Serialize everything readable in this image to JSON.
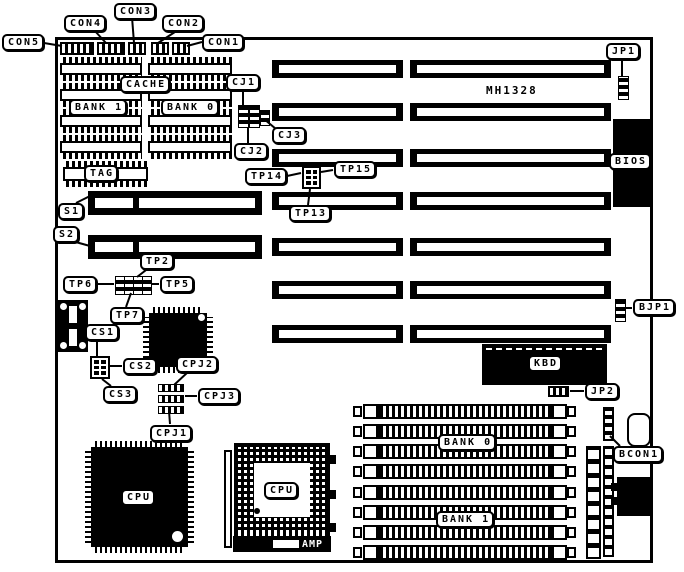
{
  "board": {
    "model_text": "MH1328"
  },
  "labels": {
    "con1": "CON1",
    "con2": "CON2",
    "con3": "CON3",
    "con4": "CON4",
    "con5": "CON5",
    "jp1": "JP1",
    "jp2": "JP2",
    "bjp1": "BJP1",
    "bcon1": "BCON1",
    "cj1": "CJ1",
    "cj2": "CJ2",
    "cj3": "CJ3",
    "tp2": "TP2",
    "tp5": "TP5",
    "tp6": "TP6",
    "tp7": "TP7",
    "tp13": "TP13",
    "tp14": "TP14",
    "tp15": "TP15",
    "s1": "S1",
    "s2": "S2",
    "cs1": "CS1",
    "cs2": "CS2",
    "cs3": "CS3",
    "cpj1": "CPJ1",
    "cpj2": "CPJ2",
    "cpj3": "CPJ3",
    "cache": "CACHE",
    "cache_bank1": "BANK 1",
    "cache_bank0": "BANK 0",
    "tag": "TAG",
    "simm_bank0": "BANK 0",
    "simm_bank1": "BANK 1",
    "kbd": "KBD",
    "bios": "BIOS",
    "cpu_qfp": "CPU",
    "cpu_pga": "CPU",
    "amp": "AMP"
  },
  "colors": {
    "ink": "#000000",
    "paper": "#ffffff"
  }
}
